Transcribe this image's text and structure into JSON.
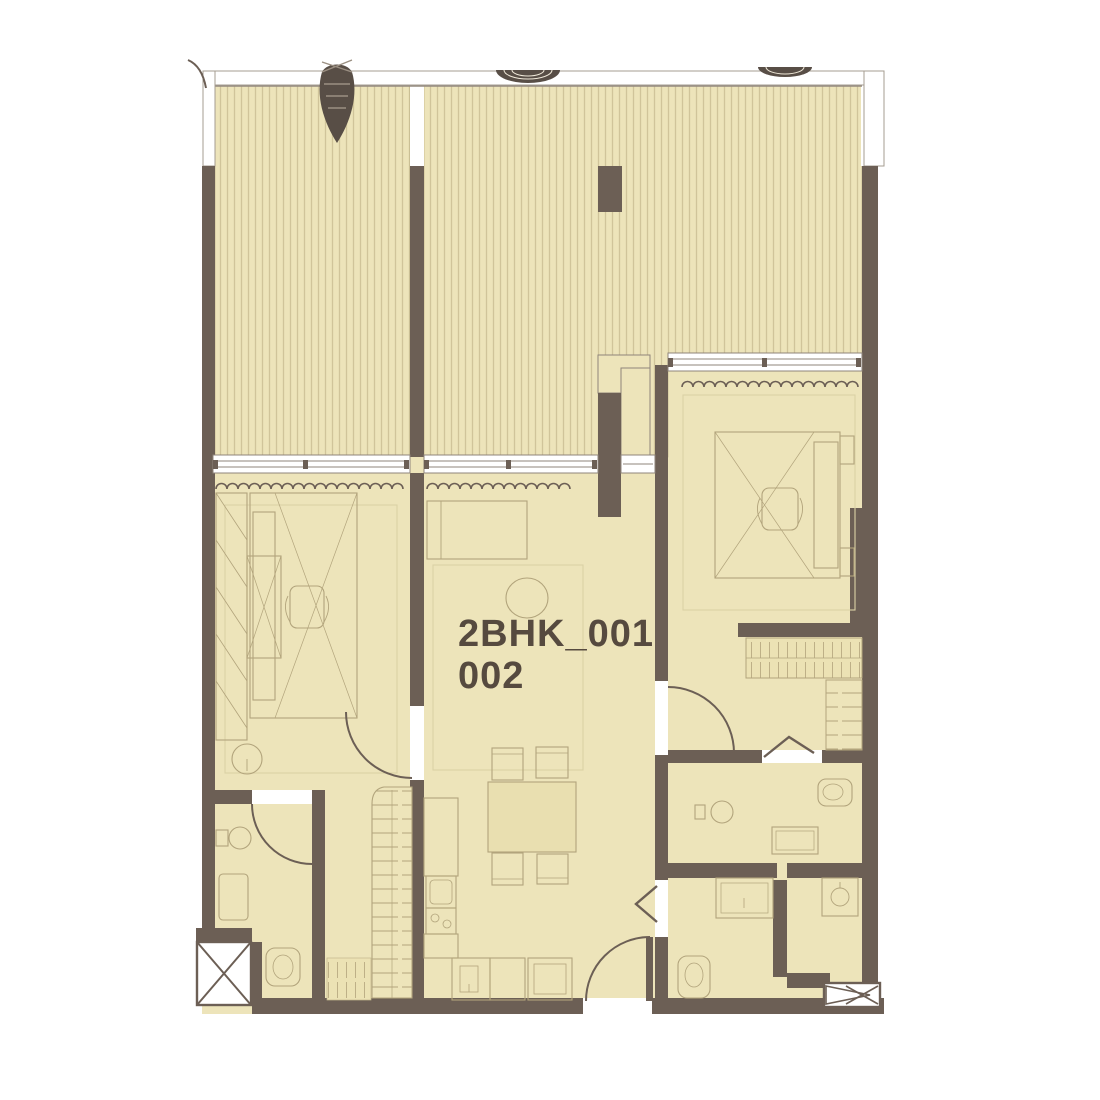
{
  "plan": {
    "type": "floor-plan",
    "unit_label": {
      "line1": "2BHK_001",
      "line2": "002"
    }
  },
  "colors": {
    "background": "#ffffff",
    "wall": "#6c5f55",
    "wall_dark_plant": "#584e46",
    "floor": "#ede4ba",
    "deck_stripe": "#d0c49a",
    "furniture_outline": "#b2a47c",
    "faint_line": "#dbd1a6",
    "window_frame": "#8f857b",
    "label_text": "#564a3f"
  }
}
